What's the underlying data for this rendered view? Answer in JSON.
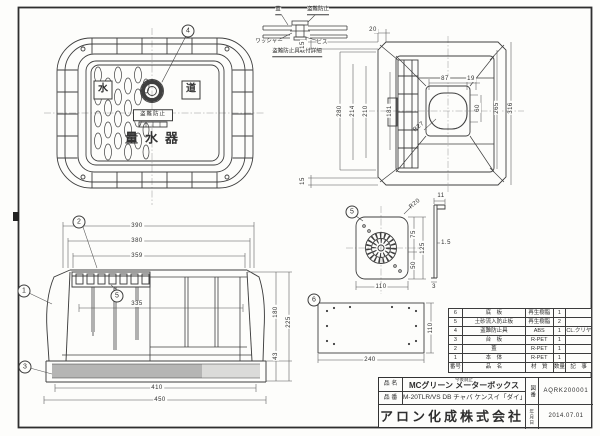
{
  "lid_view": {
    "callout4": "4",
    "kanji_left": "水",
    "kanji_right": "道",
    "banner": "盗難防止",
    "meter": "量水器"
  },
  "bolt_detail": {
    "lid": "蓋",
    "device": "盗難防止",
    "washer": "ワッシャー",
    "screw": "ビス",
    "title": "盗難防止具取付詳細"
  },
  "body_plan": {
    "d20": "20",
    "d15_top": "15",
    "d15_bot": "15",
    "d280": "280",
    "d214": "214",
    "d210": "210",
    "d181": "181",
    "d87": "87",
    "d19": "19",
    "d60": "60",
    "r27": "R27",
    "d265": "265",
    "d316": "316"
  },
  "side_view": {
    "c1": "1",
    "c2": "2",
    "c3": "3",
    "c5": "5",
    "d390": "390",
    "d380": "380",
    "d359": "359",
    "d335": "335",
    "d410": "410",
    "d450": "450",
    "d180": "180",
    "d225": "225",
    "d43": "43"
  },
  "plate_detail": {
    "c5": "5",
    "r20": "R20",
    "d75": "75",
    "d50": "50",
    "d125": "125",
    "d110": "110",
    "d11": "11",
    "d1_5": "1.5",
    "d3": "3"
  },
  "base_detail": {
    "c6": "6",
    "d240": "240",
    "d110": "110"
  },
  "parts_table": {
    "headers": {
      "no": "番号",
      "name": "品　名",
      "material": "材　質",
      "qty": "数量",
      "note": "記　事"
    },
    "rows": [
      {
        "no": "6",
        "name": "底　板",
        "material": "再生樹脂",
        "qty": "1",
        "note": ""
      },
      {
        "no": "5",
        "name": "土砂流入防止板",
        "material": "再生樹脂",
        "qty": "2",
        "note": ""
      },
      {
        "no": "4",
        "name": "盗難防止具",
        "material": "ABS",
        "qty": "1",
        "note": "CL.クリヤー"
      },
      {
        "no": "3",
        "name": "台　板",
        "material": "R-PET",
        "qty": "1",
        "note": ""
      },
      {
        "no": "2",
        "name": "蓋",
        "material": "R-PET",
        "qty": "1",
        "note": ""
      },
      {
        "no": "1",
        "name": "本　体",
        "material": "R-PET",
        "qty": "1",
        "note": ""
      }
    ]
  },
  "title_block": {
    "item_label": "品 名",
    "item_note": "今後廃止",
    "item_name": "MCグリーン  メーターボックス",
    "model_label": "品 番",
    "model": "M-20TLR/VS DB チャバ ケンスイ「ダイ」",
    "company": "アロン化成株式会社",
    "drawing_no_label": "図番",
    "drawing_no": "AQRK200001",
    "date_label": "年月日",
    "date": "2014.07.01"
  }
}
